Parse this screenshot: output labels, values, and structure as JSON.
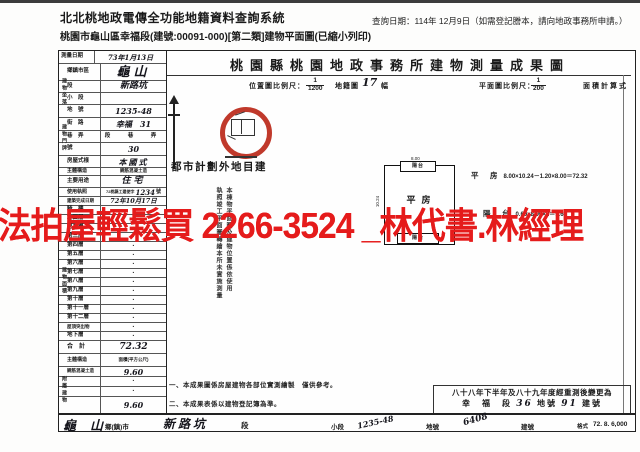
{
  "page": {
    "system_title": "北北桃地政電傳全功能地籍資料查詢系統",
    "query_date": "查詢日期：114年 12月9日（如需登記謄本，請向地政事務所申請。）",
    "subtitle": "桃園市龜山區幸福段(建號:00091-000)[第二類]建物平面圖(已縮小列印)"
  },
  "doc": {
    "title": "桃園縣桃園地政事務所建物測量成果圖",
    "scale": {
      "loc_label": "位置圖比例尺：",
      "loc_num": "1",
      "loc_den": "1200",
      "sheet_label": "地籍圖",
      "sheet_no": "17",
      "sheet_unit": "幅",
      "plan_label": "平面圖比例尺：",
      "plan_num": "1",
      "plan_den": "200",
      "calc_label": "面積計算式"
    },
    "zone_note": "都市計劃外地目建",
    "stamp": {
      "col1": "本棟物平面圖及建物位置係依使用",
      "col2": "執照竣工平面圖轉繪本所未實施測量"
    },
    "plan": {
      "balcony_top": "陽台",
      "balcony_bottom": "陽台",
      "room": "平房",
      "dim_top": "8.00",
      "dim_left": "10.24",
      "calc1_name": "平　房",
      "calc1": "8.00×10.24－1.20×8.00＝72.32",
      "calc2_name": "陽　台",
      "calc2": "0.60×8.00×2＝9.60"
    },
    "notes": {
      "n1": "一、本成果圖係房屋建物各部位實測繪製　僅供參考。",
      "n2": "二、本成果表係以建物登記簿為準。"
    },
    "remeasure": {
      "line1": "八十八年下半年及八十九年度經重測後變更為",
      "sec": "幸　福　段",
      "lot": "36",
      "lot_u": "地號",
      "bld": "91",
      "bld_u": "建號"
    },
    "footer": {
      "town": "龜山",
      "town_u": "鄉(鎮)市",
      "sec": "新路坑",
      "sec_u": "段",
      "subsec_u": "小段",
      "lot": "1235-48",
      "lot_u": "地號",
      "bld": "6408",
      "bld_u": "建號",
      "fmt_label": "格式",
      "fmt_no": "72. 8. 6,000"
    }
  },
  "form": {
    "groups": [
      "建物坐落",
      "建物門牌",
      "建物面積",
      "附屬建物"
    ],
    "rows": [
      {
        "label": "測量日期",
        "value": "73年1月13日",
        "unit": ""
      },
      {
        "label": "鄉鎮市區",
        "value": "龜山",
        "unit": ""
      },
      {
        "label": "段",
        "value": "新路坑",
        "unit": "段"
      },
      {
        "label": "小　段",
        "value": "",
        "unit": "小段"
      },
      {
        "label": "地　號",
        "value": "1235-48",
        "unit": "地號"
      },
      {
        "label": "街　路",
        "value": "幸福　31",
        "unit": "鄰路"
      },
      {
        "label": "巷　弄",
        "value": "",
        "unit": "段　巷　弄"
      },
      {
        "label": "號",
        "value": "30",
        "unit": "號之　號"
      },
      {
        "label": "房屋式樣",
        "value": "本國式",
        "unit": ""
      },
      {
        "label": "主體構造",
        "value": "鋼筋混凝土造",
        "unit": ""
      },
      {
        "label": "主要用途",
        "value": "住宅",
        "unit": ""
      },
      {
        "label": "使用執照",
        "value": "72桃縣工建使字",
        "no": "1234",
        "unit": "號"
      },
      {
        "label": "建築完成日期",
        "value": "72年10月17日",
        "unit": ""
      }
    ],
    "floors": [
      {
        "label": "騎　樓",
        "value": "·"
      },
      {
        "label": "地面層",
        "value": "·"
      },
      {
        "label": "第二層",
        "value": "·"
      },
      {
        "label": "第三層",
        "value": "·"
      },
      {
        "label": "第四層",
        "value": "·"
      },
      {
        "label": "第五層",
        "value": "·"
      },
      {
        "label": "第六層",
        "value": "·"
      },
      {
        "label": "第七層",
        "value": "·"
      },
      {
        "label": "第八層",
        "value": "·"
      },
      {
        "label": "第九層",
        "value": "·"
      },
      {
        "label": "第十層",
        "value": "·"
      },
      {
        "label": "第十一層",
        "value": "·"
      },
      {
        "label": "第十二層",
        "value": "·"
      },
      {
        "label": "屋頂突出物",
        "value": "·"
      },
      {
        "label": "地下層",
        "value": "·"
      }
    ],
    "total_label": "合　計",
    "total_value": "72.32",
    "annex": {
      "h1": "主體構造",
      "h2": "面積(平方公尺)",
      "rows": [
        {
          "c1": "鋼筋混凝土造",
          "c2": "9.60"
        },
        {
          "c1": "",
          "c2": "·"
        },
        {
          "c1": "",
          "c2": "·"
        }
      ],
      "total": "9.60"
    }
  },
  "watermark": {
    "text": "法拍屋輕鬆買 2266-3524 _林代書.林經理",
    "color": "#e51b1b"
  }
}
